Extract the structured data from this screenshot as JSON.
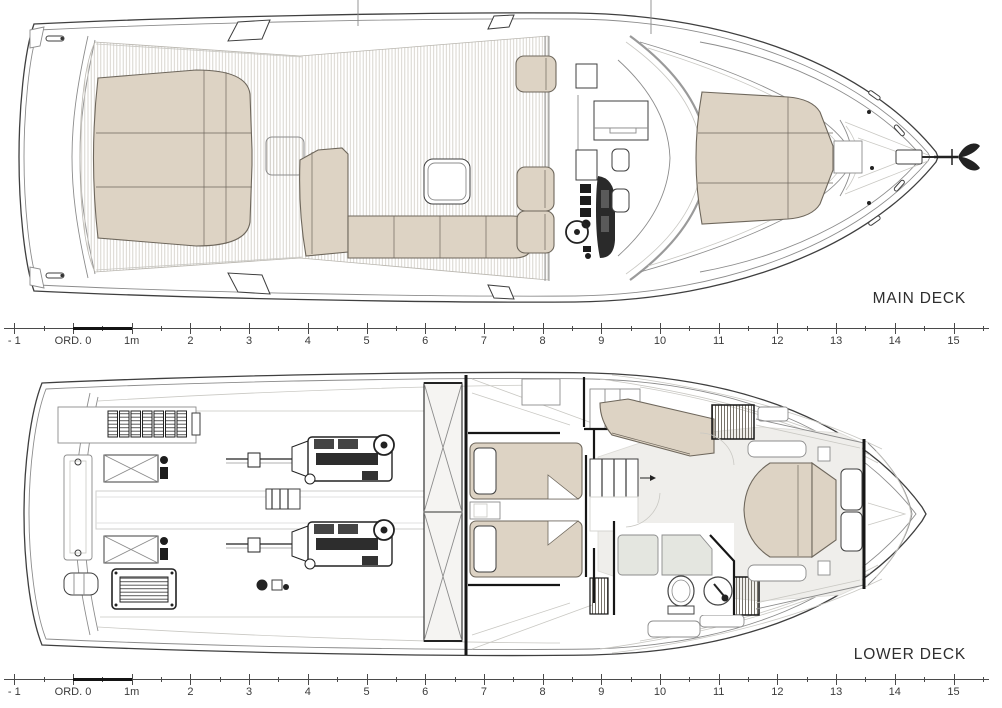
{
  "palette": {
    "ink": "#2e2e2e",
    "line_dark": "#3f3f3f",
    "line_mid": "#8c8c8c",
    "line_light": "#c9c8c3",
    "upholstery": "#ddd3c4",
    "upholstery_border": "#6e675c",
    "teak_stripe": "#d3d0c9",
    "floor": "#efeeeb",
    "fixture": "#e4e6e0",
    "wall": "#161616",
    "ruler_line": "#4a4a4a",
    "ruler_ink": "#3a3a3a"
  },
  "decks": [
    {
      "id": "main",
      "label": "MAIN DECK"
    },
    {
      "id": "lower",
      "label": "LOWER DECK"
    }
  ],
  "ruler": {
    "labels": [
      "- 1",
      "ORD. 0",
      "1m",
      "2",
      "3",
      "4",
      "5",
      "6",
      "7",
      "8",
      "9",
      "10",
      "11",
      "12",
      "13",
      "14",
      "15"
    ],
    "min": -1,
    "max": 15.5,
    "minor_step": 0.5,
    "origin_px": 73,
    "px_per_meter": 58.7,
    "highlight": {
      "from": 0,
      "to": 1
    }
  }
}
